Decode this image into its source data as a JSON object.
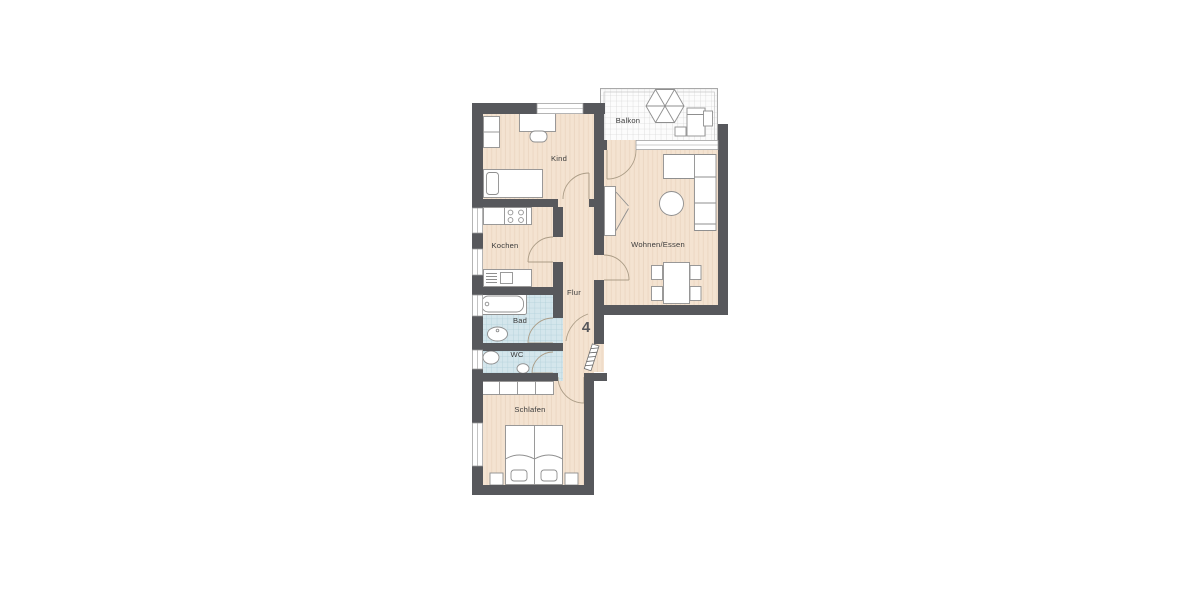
{
  "plan": {
    "type": "apartment-floorplan",
    "apartment_number": "4",
    "rooms": {
      "kind": {
        "label": "Kind"
      },
      "kochen": {
        "label": "Kochen"
      },
      "bad": {
        "label": "Bad"
      },
      "wc": {
        "label": "WC"
      },
      "schlafen": {
        "label": "Schlafen"
      },
      "flur": {
        "label": "Flur"
      },
      "wohnen_essen": {
        "label": "Wohnen/Essen"
      },
      "balkon": {
        "label": "Balkon"
      }
    },
    "colors": {
      "background": "#ffffff",
      "wall": "#57585c",
      "floor": "#f4e3d1",
      "floor_stripe": "#ecd8c3",
      "bath_tile": "#d4e6ec",
      "bath_tile_grid": "#b2d0da",
      "balcony_tile": "#fcfcfc",
      "balcony_grid": "#d8d8d8",
      "furniture_outline": "#8f8f8f",
      "door_swing": "#ab9c86",
      "label_text": "#3b3b3b",
      "number_text": "#56575b"
    }
  }
}
